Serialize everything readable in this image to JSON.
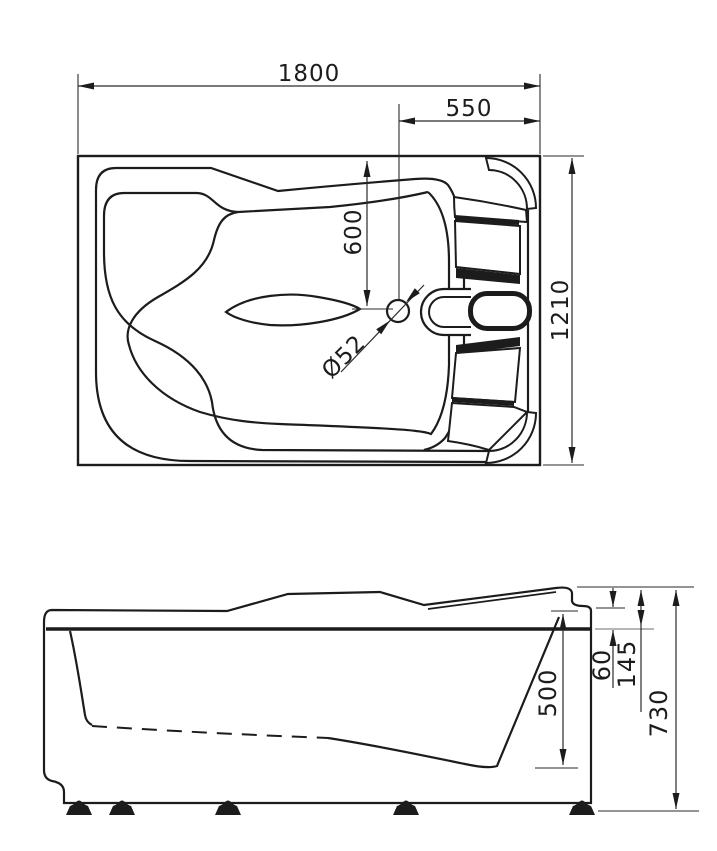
{
  "drawing": {
    "kind": "bathtub technical dimension drawing",
    "colors": {
      "ink": "#1c1c1c",
      "dimension": "#2a2a2a",
      "extension_gray": "#8a8a8a",
      "background": "#ffffff"
    }
  },
  "top_view": {
    "name": "plan view",
    "dim_overall_length": "1800",
    "dim_drain_to_right_edge": "550",
    "dim_drain_to_top_edge": "600",
    "dim_drain_diameter": "Ø52",
    "dim_overall_width": "1210"
  },
  "side_view": {
    "name": "side elevation",
    "dim_rim_step_height": "60",
    "dim_backrest_above_rim": "145",
    "dim_inner_depth": "500",
    "dim_overall_height": "730"
  }
}
